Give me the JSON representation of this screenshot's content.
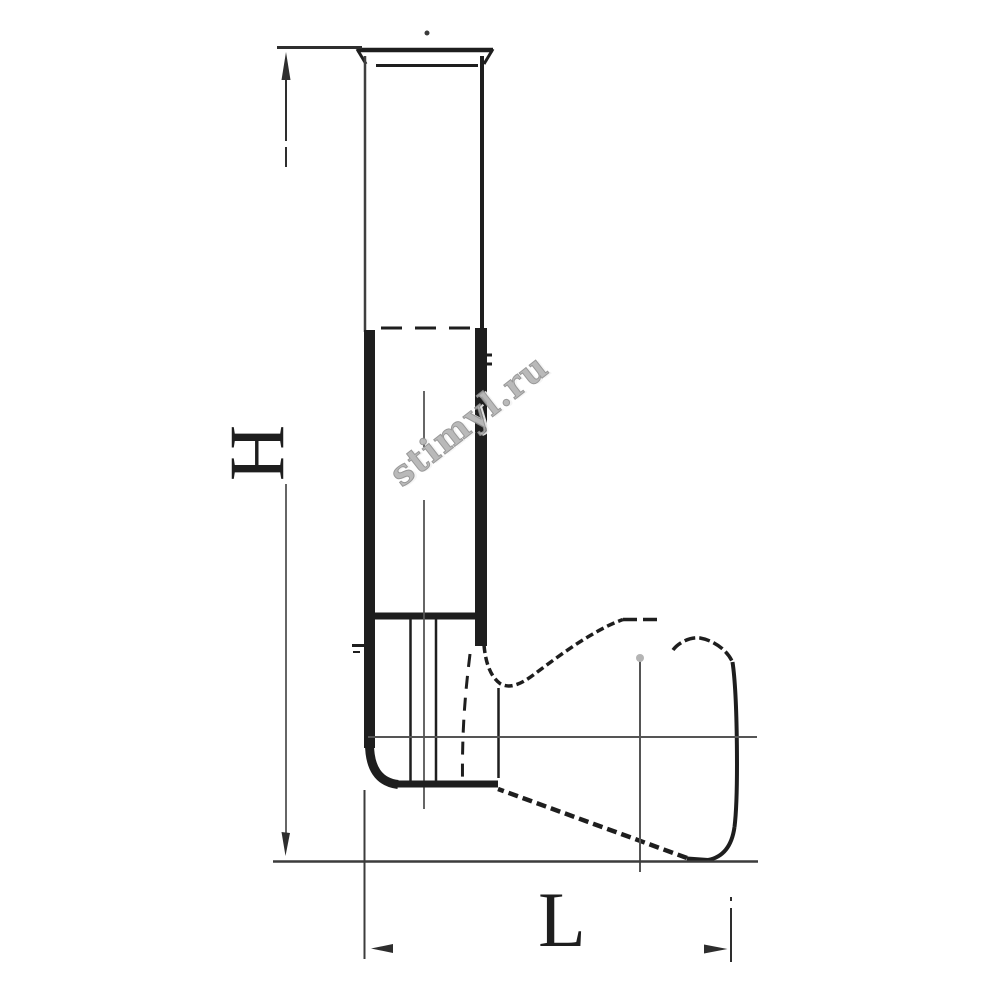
{
  "drawing": {
    "labels": {
      "height": "H",
      "length": "L"
    },
    "watermark": {
      "text": "stimyl.ru",
      "color": "#b3b3b3"
    },
    "colors": {
      "ink": "#1e1e1e",
      "wall": "#3f3f3f",
      "center": "#555555",
      "dim": "#2e2e2e",
      "baseline": "#3c3c3c",
      "wm": "#b3b3b3"
    }
  }
}
